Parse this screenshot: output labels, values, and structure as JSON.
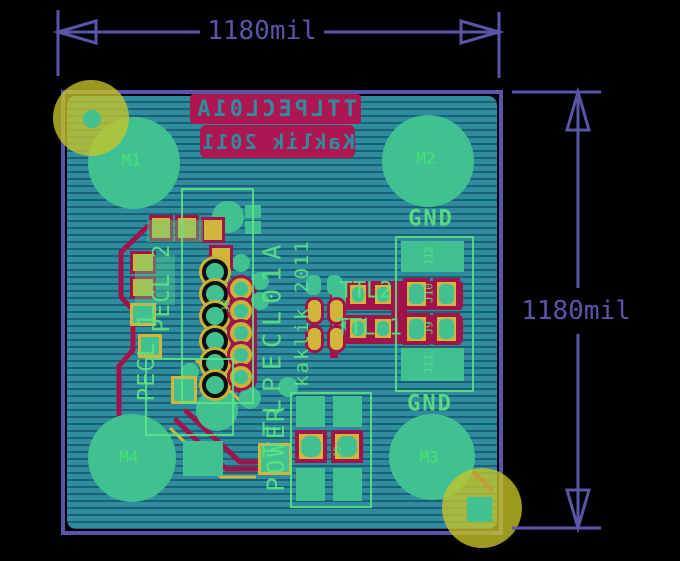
{
  "dimension_annotations": {
    "top": "1180mil",
    "right": "1180mil"
  },
  "board": {
    "back_silkscreen": {
      "line1": "TTLPECL01A",
      "line2": "Kaklik 2011"
    },
    "front_silkscreen": {
      "title": "TTLPECL01A",
      "author": "kaklik 2011",
      "power_label": "POWER",
      "pecl1_label": "PECL 1",
      "pecl2_label": "PECL 2",
      "ttl1_label": "TTL 1",
      "ttl2_label": "TTL2",
      "gnd_top_label": "GND",
      "gnd_bottom_label": "GND"
    },
    "mounting_holes": [
      {
        "label": "M1"
      },
      {
        "label": "M2"
      },
      {
        "label": "M3"
      },
      {
        "label": "M4"
      }
    ],
    "reference_designators": {
      "j5": "J5",
      "j8": "J8",
      "j9": "J9",
      "j10": "J10",
      "j11": "J11",
      "j12": "J12"
    },
    "colors": {
      "board_substrate": "#2d8d9f",
      "bottom_copper": "#a3134b",
      "top_copper": "#d2b63b",
      "bare_copper_pads": "#41c192",
      "silkscreen": "#5ce37f",
      "edge_and_dimensions": "#5a55a8",
      "keepout": "#c1c12a"
    }
  }
}
